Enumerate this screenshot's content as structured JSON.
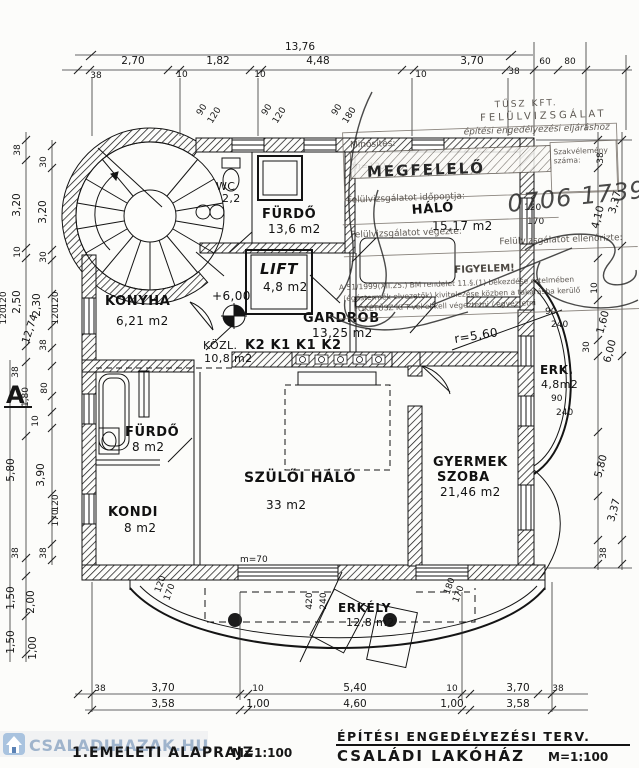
{
  "watermark": {
    "text": "CSALADIHAZAK.HU"
  },
  "titles": {
    "plan_title": "1.EMELETI ALAPRAJZ",
    "plan_scale": "M=1:100",
    "project_kind": "ÉPÍTÉSI ENGEDÉLYEZÉSI TERV.",
    "project_name": "CSALÁDI LAKÓHÁZ",
    "project_scale": "M=1:100"
  },
  "rooms": {
    "wc": {
      "name": "WC",
      "area": "2,2"
    },
    "furdo_top": {
      "name": "FÜRDŐ",
      "area": "13,6 m2"
    },
    "halo": {
      "name": "HÁLÓ",
      "area": "15,17 m2"
    },
    "lift": {
      "name": "LIFT",
      "area": "4,8 m2"
    },
    "konyha": {
      "name": "KONYHA",
      "area": "6,21 m2"
    },
    "kozl": {
      "name": "KÖZL.",
      "area": "10,8 m2"
    },
    "gardrob": {
      "name": "GARDRÓB",
      "area": "13,25 m2"
    },
    "furdo_left": {
      "name": "FÜRDŐ",
      "area": "8 m2"
    },
    "kondi": {
      "name": "KONDI",
      "area": "8 m2"
    },
    "szuloi_halo": {
      "name": "SZÜLŐI HÁLÓ",
      "area": "33 m2"
    },
    "gyermek": {
      "name_line1": "GYERMEK",
      "name_line2": "SZOBA",
      "area": "21,46 m2"
    },
    "erk": {
      "name": "ERK.",
      "area": "4,8m2"
    },
    "erkely": {
      "name": "ERKÉLY",
      "area": "12,8 m2"
    }
  },
  "stamp": {
    "head1": "TŰSZ KFT.",
    "head2": "FELÜLVIZSGÁLAT",
    "head3": "építési engedélyezési eljáráshoz",
    "minosites": "Minősítés:",
    "megfelelo": "MEGFELELŐ",
    "szakvelemeny1": "Szakvélemény",
    "szakvelemeny2": "száma:",
    "szam": "0706 1739/6",
    "idopont": "Felülvizsgálatot időpontja:",
    "vegezte": "Felülvizsgálatot végezte:",
    "ellenorizte": "Felülvizsgálatot ellenőrizte:",
    "figyelem": "FIGYELEM!",
    "warn1": "A 51/1999(XII.25.) BM rendelet 11.§.(1) bekezdése értelmében",
    "warn2": "(égéstermék elvezetők) kivitelezése közben a takarásba kerülő",
    "warn3": "FŐKÉTŰSZ KFT-vel el kell végeztetni / egyeztetni"
  },
  "annotations": {
    "level_mark": "+6,00",
    "radius": "r=5,60",
    "k_row": "K2 K1 K1 K2",
    "parapet": "m=70",
    "m120": "m=120",
    "section_mark": "A"
  },
  "dims": {
    "top_total": "13,76",
    "top": [
      "2,70",
      "1,82",
      "4,48",
      "3,70"
    ],
    "top_small": [
      "38",
      "10",
      "10",
      "10",
      "38",
      "60",
      "80"
    ],
    "left": [
      "38",
      "3,20",
      "10",
      "2,50",
      "12,74",
      "120",
      "120",
      "30",
      "3,20",
      "30",
      "2,30",
      "120",
      "120",
      "38",
      "80",
      "38",
      "1,80",
      "10",
      "3,90",
      "120",
      "170",
      "38",
      "38",
      "5,80",
      "1,50",
      "1,50",
      "2,00",
      "1,00"
    ],
    "right": [
      "38",
      "3,37",
      "4,10",
      "10",
      "1,60",
      "30",
      "6,00",
      "5,80",
      "3,37",
      "38"
    ],
    "bottom_outer": [
      "38",
      "3,70",
      "10",
      "5,40",
      "10",
      "3,70",
      "38"
    ],
    "bottom_inner": [
      "3,58",
      "1,00",
      "4,60",
      "1,00",
      "3,58"
    ],
    "windows": {
      "win1": [
        "90",
        "120"
      ],
      "win2": [
        "90",
        "120"
      ],
      "win3": [
        "90",
        "180"
      ],
      "win4": [
        "120",
        "170"
      ],
      "erk_a": [
        "90",
        "240"
      ],
      "erk_b": [
        "90",
        "240"
      ],
      "balc_a": [
        "420",
        "240"
      ],
      "balc_b": [
        "180",
        "170"
      ],
      "balc_c": [
        "120",
        "170"
      ]
    }
  }
}
